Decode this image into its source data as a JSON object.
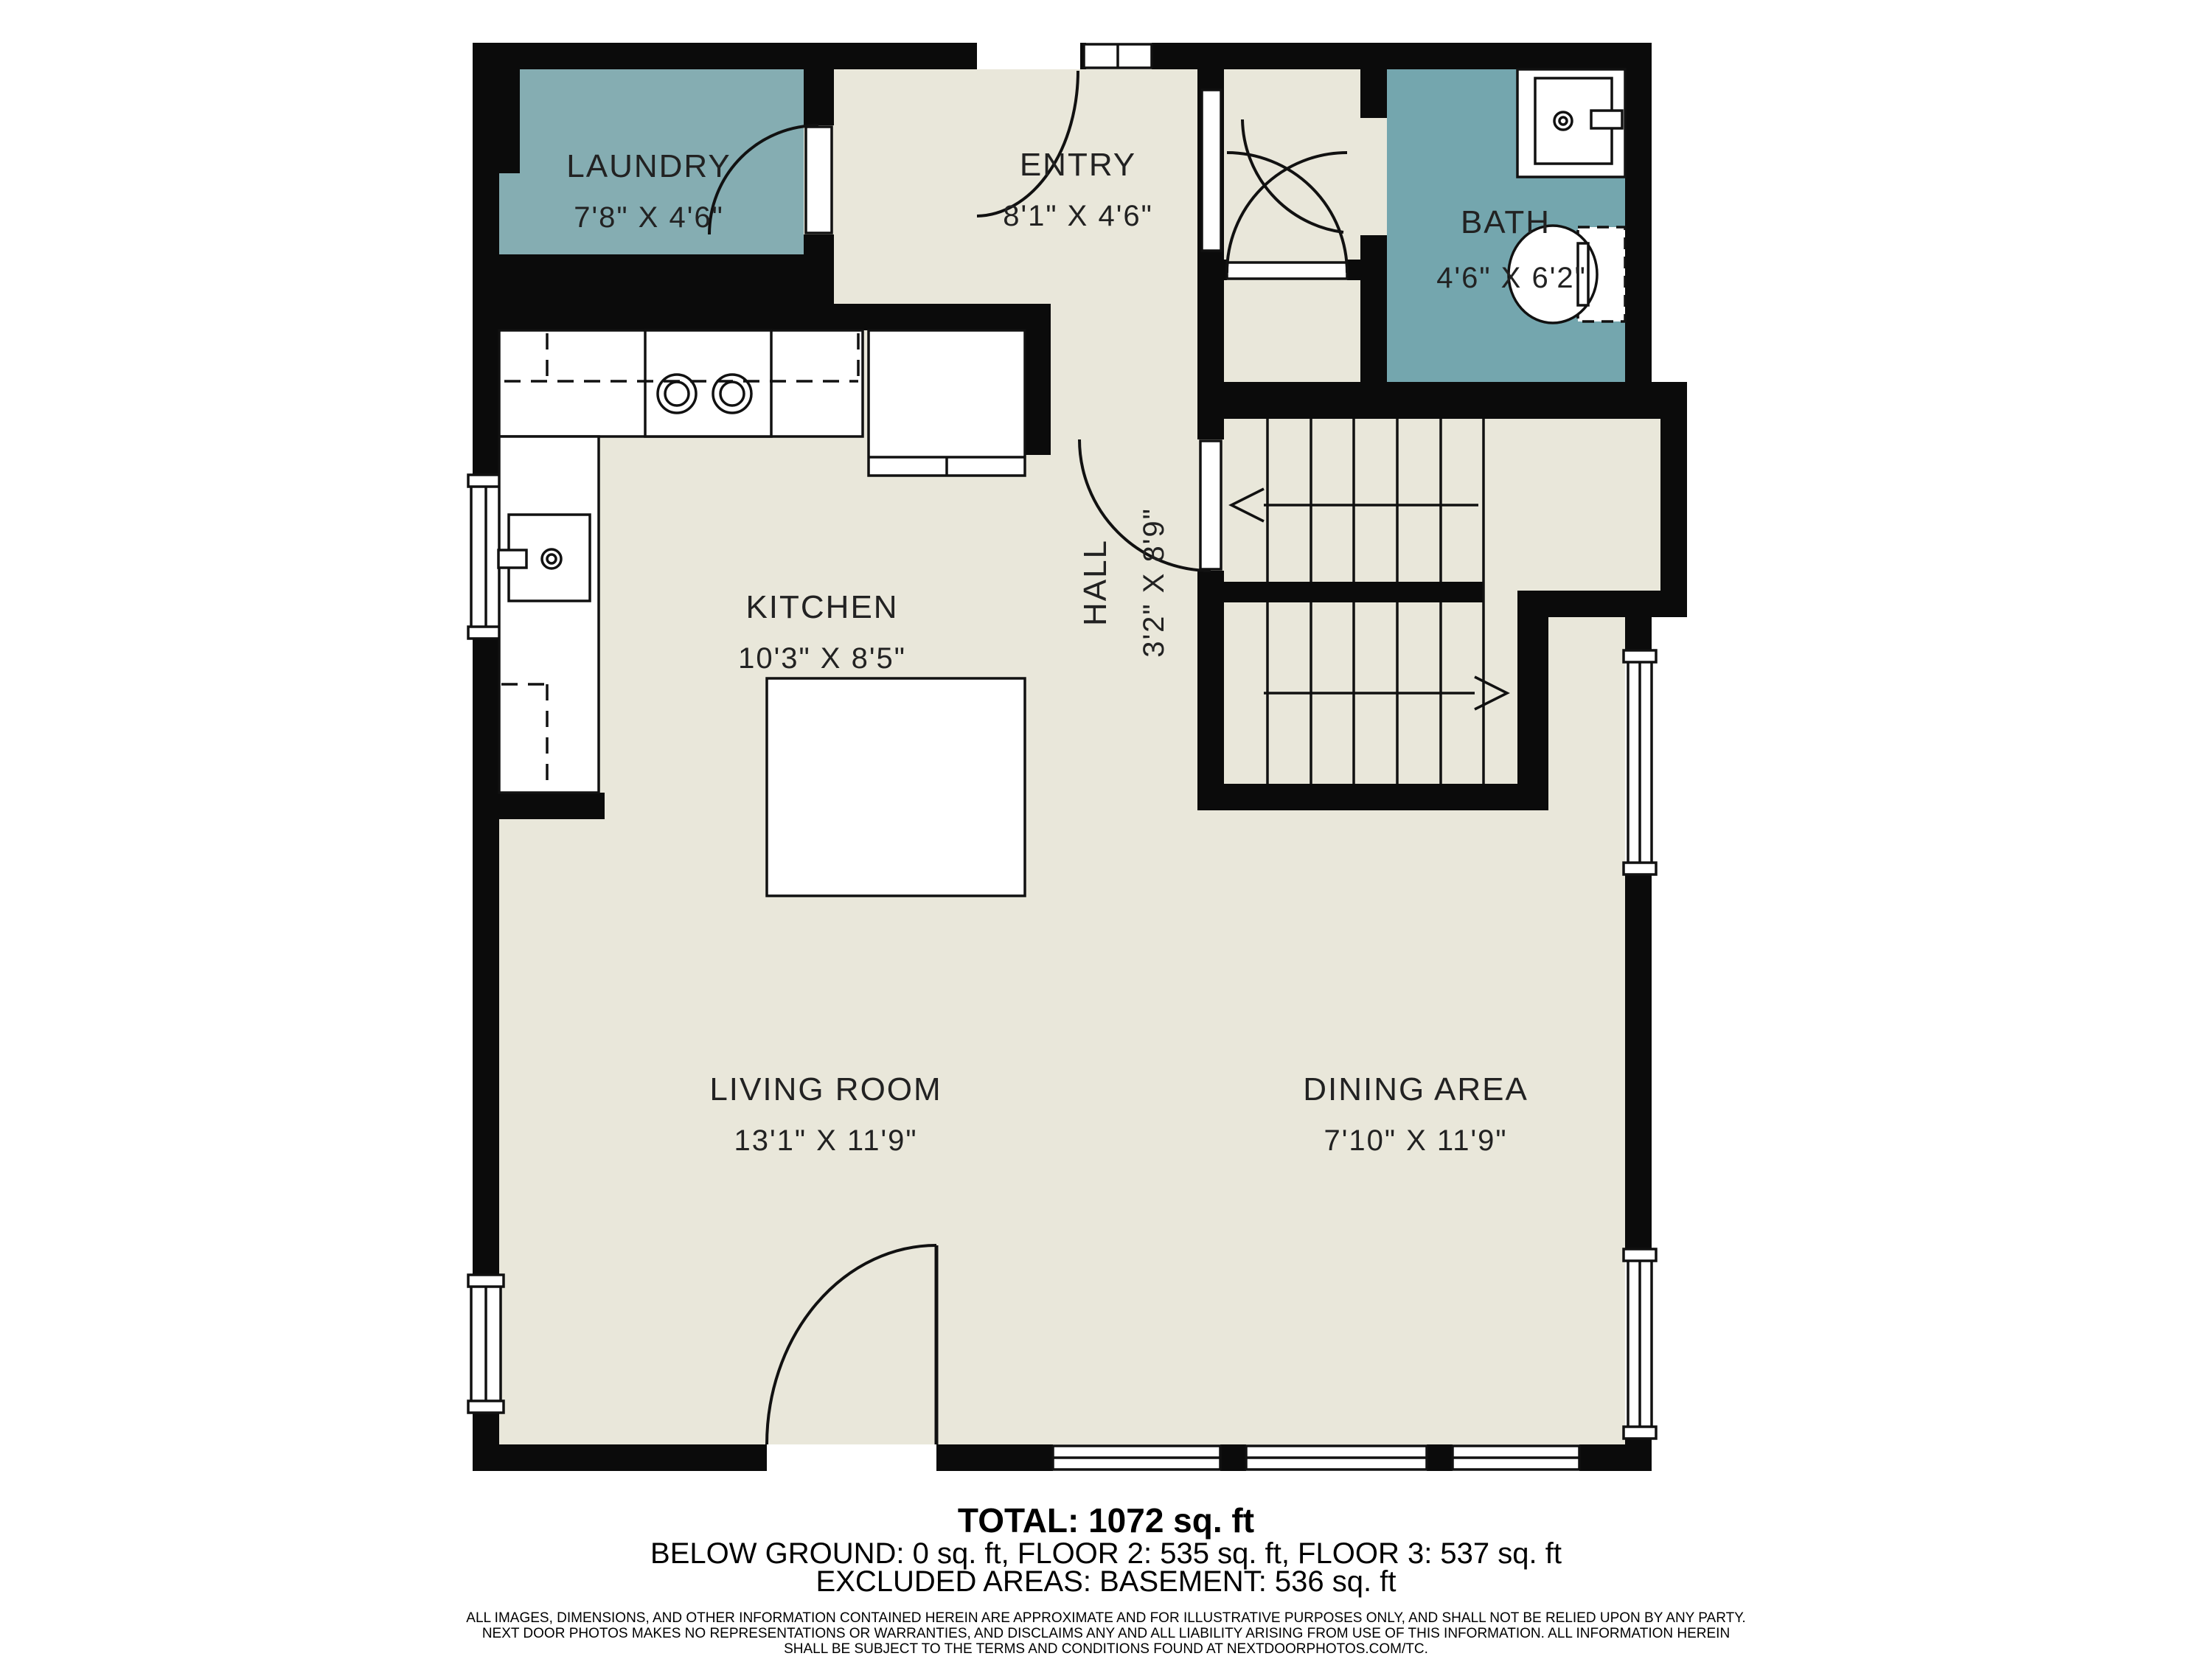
{
  "plan": {
    "colors": {
      "wall": "#0b0b0b",
      "floor": "#e9e7da",
      "laundry_fill": "#85adb2",
      "bath_fill": "#74a6ae",
      "fixture_fill": "#ffffff"
    },
    "rooms": [
      {
        "id": "laundry",
        "name": "LAUNDRY",
        "dims": "7'8\" X 4'6\""
      },
      {
        "id": "entry",
        "name": "ENTRY",
        "dims": "8'1\" X 4'6\""
      },
      {
        "id": "bath",
        "name": "BATH",
        "dims": "4'6\" X 6'2\""
      },
      {
        "id": "kitchen",
        "name": "KITCHEN",
        "dims": "10'3\" X 8'5\""
      },
      {
        "id": "hall",
        "name": "HALL",
        "dims": "3'2\" X 8'9\""
      },
      {
        "id": "living",
        "name": "LIVING ROOM",
        "dims": "13'1\" X 11'9\""
      },
      {
        "id": "dining",
        "name": "DINING AREA",
        "dims": "7'10\" X 11'9\""
      }
    ]
  },
  "footer": {
    "total": "TOTAL: 1072 sq. ft",
    "floors": "BELOW GROUND: 0 sq. ft, FLOOR 2: 535 sq. ft, FLOOR 3: 537 sq. ft",
    "excluded": "EXCLUDED AREAS: BASEMENT: 536 sq. ft",
    "disclaimer": [
      "ALL IMAGES, DIMENSIONS, AND OTHER INFORMATION CONTAINED HEREIN ARE APPROXIMATE AND FOR ILLUSTRATIVE PURPOSES ONLY, AND SHALL NOT BE RELIED UPON BY ANY PARTY.",
      "NEXT DOOR PHOTOS MAKES NO REPRESENTATIONS OR WARRANTIES, AND DISCLAIMS ANY AND ALL LIABILITY ARISING FROM USE OF THIS INFORMATION. ALL INFORMATION HEREIN",
      "SHALL BE SUBJECT TO THE TERMS AND CONDITIONS FOUND AT NEXTDOORPHOTOS.COM/TC."
    ]
  }
}
